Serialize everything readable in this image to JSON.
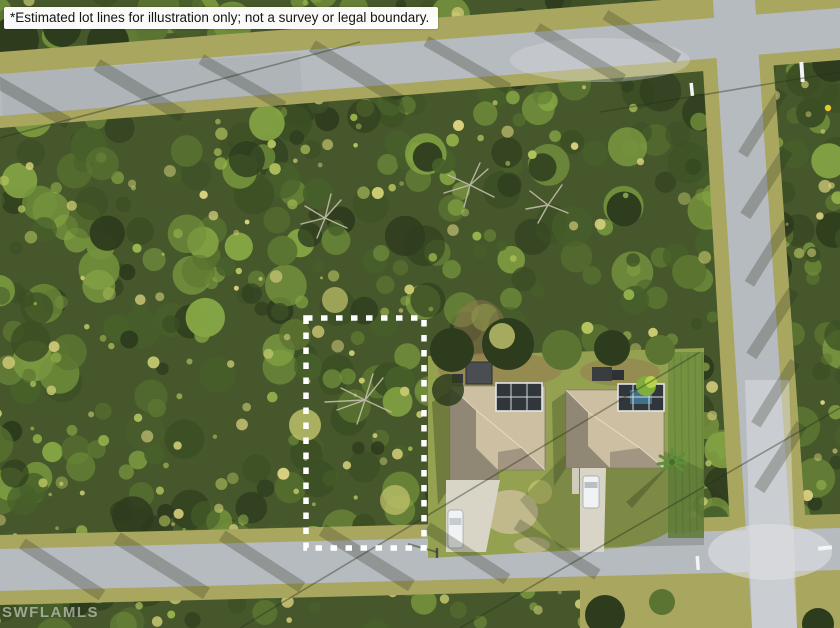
{
  "banner": {
    "text": "*Estimated lot lines for illustration only; not a survey or legal boundary."
  },
  "watermark": {
    "text": "SWFLAMLS"
  },
  "scene": {
    "type": "aerial-drone-photo",
    "subject": "vacant wooded residential lot outlined with dashed lot lines beside two homes with screened pool enclosures",
    "lot_outline": {
      "x": 306,
      "y": 318,
      "width": 118,
      "height": 230,
      "stroke": "#ffffff",
      "stroke_width": 5.5,
      "dash": "6.5 8.5"
    },
    "colors": {
      "forest-base": "#46582b",
      "forest-dark": "#2e3c1e",
      "forest-mid": "#5b7431",
      "forest-light": "#85a544",
      "forest-bright": "#c4c56e",
      "grass-verge": "#a9a660",
      "lawn": "#93a150",
      "lawn-dark": "#6f8e3f",
      "road": "#b6bbc0",
      "road-light": "#dde0e2",
      "roof-light": "#cdbfa2",
      "roof-dark": "#857c6c",
      "cage": "#31363b",
      "pool": "#4486a5",
      "driveway": "#d8d4c6",
      "dirt": "#977851",
      "sand": "#c9bd97",
      "car": "#f1f2f3",
      "shadow": "#25301a",
      "marking": "#f2f4f5",
      "sign": "#e8c832"
    },
    "texture": {
      "seed": 7,
      "blobs": 560,
      "sparkles": 300,
      "palette": [
        "#2e3c1e",
        "#3c4f24",
        "#47602a",
        "#5b7431",
        "#73923c",
        "#85a544"
      ],
      "bright_palette": [
        "#9cb84e",
        "#b5c45f",
        "#c9ca72",
        "#d8d07e"
      ]
    }
  }
}
